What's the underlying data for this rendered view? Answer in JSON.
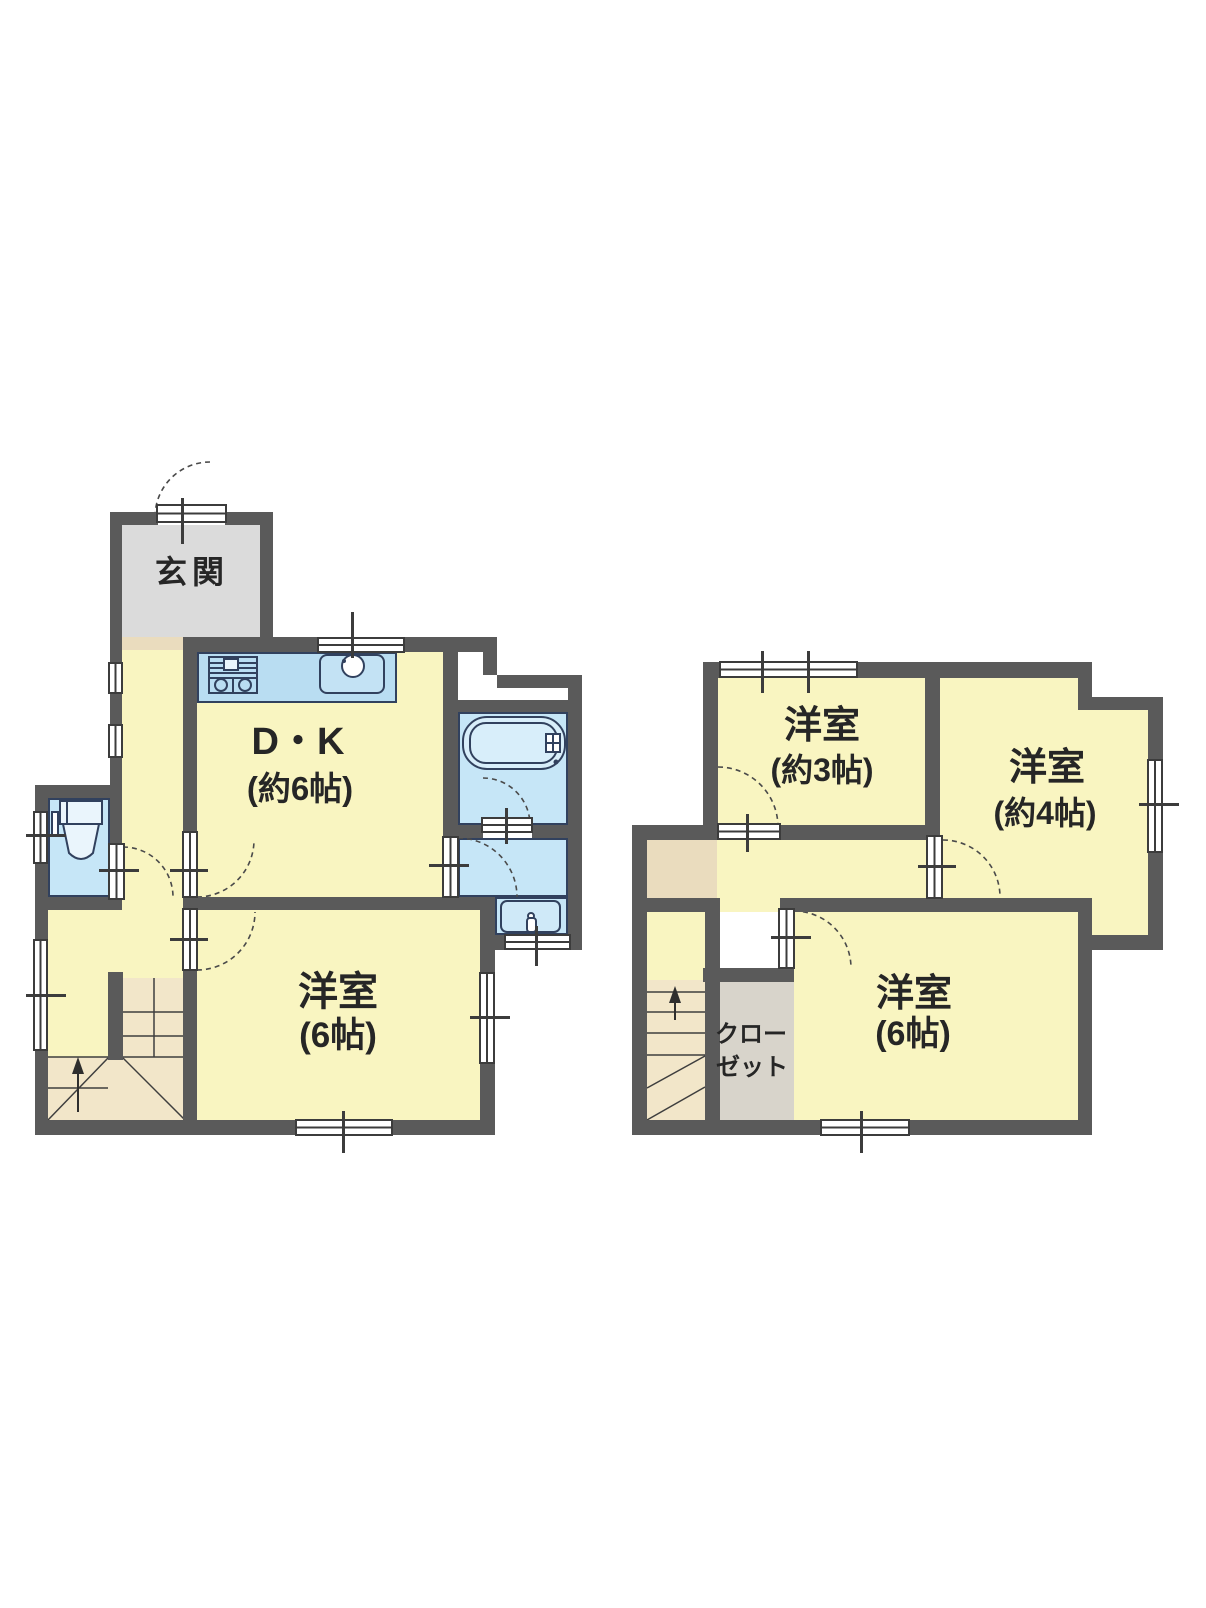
{
  "title": "2-story floor plan",
  "colors": {
    "wall": "#5A5A5A",
    "room_yellow": "#F9F5C1",
    "water_blue": "#C6E6F7",
    "counter_blue": "#B9DDF2",
    "entrance_gray": "#DBDBDB",
    "closet_gray": "#D8D4CB",
    "step_beige": "#EADCBE",
    "stair_beige": "#F2E6C9",
    "fixture_line": "#31415E"
  },
  "floor1": {
    "entrance": {
      "label": "玄関"
    },
    "dining_kitchen": {
      "label": "D・K",
      "size": "(約6帖)"
    },
    "western_room": {
      "label": "洋室",
      "size": "(6帖)"
    },
    "fixtures": {
      "stove": "stove-icon",
      "sink": "kitchen-sink-icon",
      "bathtub": "bathtub-icon",
      "toilet": "toilet-icon",
      "washbasin": "washbasin-icon"
    },
    "stairs": {
      "icon": "up-arrow-icon"
    }
  },
  "floor2": {
    "room_3": {
      "label": "洋室",
      "size": "(約3帖)"
    },
    "room_4": {
      "label": "洋室",
      "size": "(約4帖)"
    },
    "room_6": {
      "label": "洋室",
      "size": "(6帖)"
    },
    "closet": {
      "line1": "クロー",
      "line2": "ゼット"
    },
    "stairs": {
      "icon": "up-arrow-icon"
    }
  }
}
